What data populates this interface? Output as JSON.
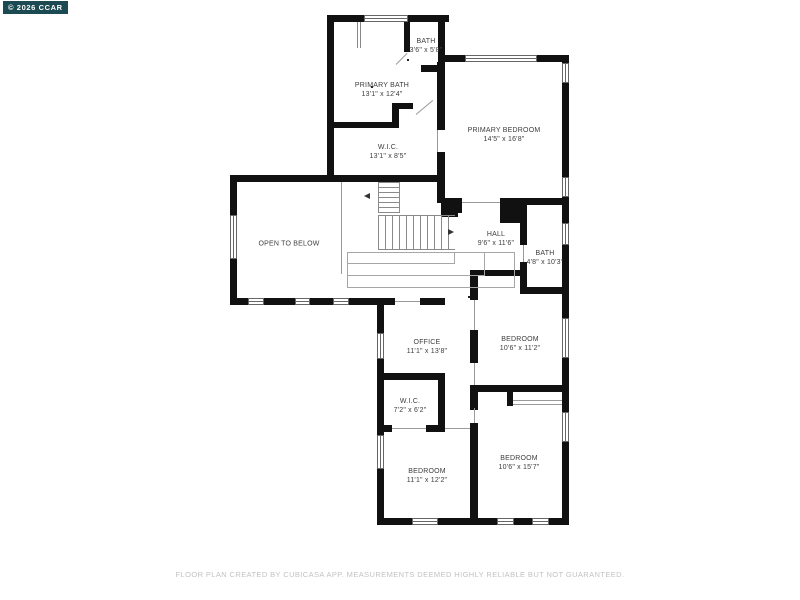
{
  "badge": {
    "text": "© 2026 CCAR"
  },
  "rooms": [
    {
      "id": "bath-top",
      "label": "BATH",
      "dims": "3'6\" x 5'8\""
    },
    {
      "id": "primary-bath",
      "label": "PRIMARY BATH",
      "dims": "13'1\" x 12'4\""
    },
    {
      "id": "wic-upper",
      "label": "W.I.C.",
      "dims": "13'1\" x 8'5\""
    },
    {
      "id": "primary-bedroom",
      "label": "PRIMARY BEDROOM",
      "dims": "14'5\" x 16'8\""
    },
    {
      "id": "open-to-below",
      "label": "OPEN TO BELOW",
      "dims": ""
    },
    {
      "id": "hall",
      "label": "HALL",
      "dims": "9'6\" x 11'6\""
    },
    {
      "id": "bath-right",
      "label": "BATH",
      "dims": "4'8\" x 10'3\""
    },
    {
      "id": "bedroom-mid",
      "label": "BEDROOM",
      "dims": "10'6\" x 11'2\""
    },
    {
      "id": "office",
      "label": "OFFICE",
      "dims": "11'1\" x 13'8\""
    },
    {
      "id": "wic-lower",
      "label": "W.I.C.",
      "dims": "7'2\" x 6'2\""
    },
    {
      "id": "bedroom-bottom-left",
      "label": "BEDROOM",
      "dims": "11'1\" x 12'2\""
    },
    {
      "id": "bedroom-bottom-right",
      "label": "BEDROOM",
      "dims": "10'6\" x 15'7\""
    }
  ],
  "footer": {
    "text": "FLOOR PLAN CREATED BY CUBICASA APP. MEASUREMENTS DEEMED HIGHLY RELIABLE BUT NOT GUARANTEED."
  },
  "colors": {
    "wall": "#111111",
    "badge_bg": "#1b4a53",
    "badge_text": "#ffffff",
    "label_text": "#3d3d3d",
    "footer_text": "#c2c2c2"
  }
}
